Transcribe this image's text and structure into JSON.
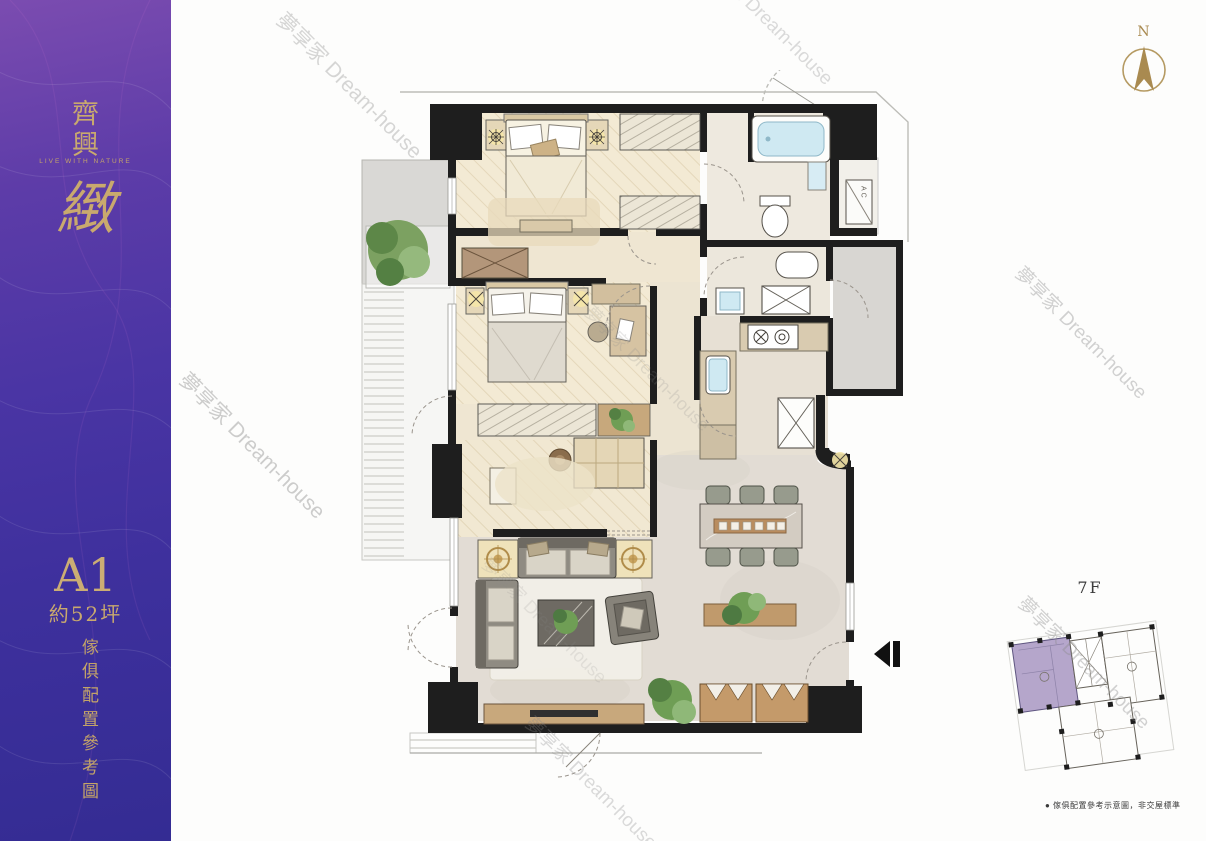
{
  "sidebar": {
    "brand_name": "齊興",
    "brand_tagline": "LIVE WITH NATURE",
    "brand_script": "緻",
    "unit_label": "A1",
    "unit_area": "約52坪",
    "side_note": "傢俱配置參考圖"
  },
  "compass": {
    "north_label": "N"
  },
  "floorplan": {
    "ac_label": "AC"
  },
  "keyplan": {
    "floor_label": "7F",
    "caption": "● 傢俱配置參考示意圖，非交屋標準",
    "highlight_color": "#b5a6cb"
  },
  "watermarks": [
    {
      "text": "夢享家 Dream-house"
    },
    {
      "text": "夢享家 Dream-house"
    },
    {
      "text": "夢享家 Dream-house"
    },
    {
      "text": "夢享家 Dream-house"
    },
    {
      "text": "夢享家 Dream-house"
    },
    {
      "text": "夢享家 Dream-house"
    },
    {
      "text": "夢享家 Dream-house"
    },
    {
      "text": "夢享家 Dream-house"
    }
  ],
  "colors": {
    "gold": "#c9a96e",
    "wall": "#1e1e1e",
    "wood_floor": "#f3ead4",
    "marble_floor": "#e2dcd4",
    "water_blue": "#cfe9f2",
    "plant_green": "#6f9e55"
  }
}
